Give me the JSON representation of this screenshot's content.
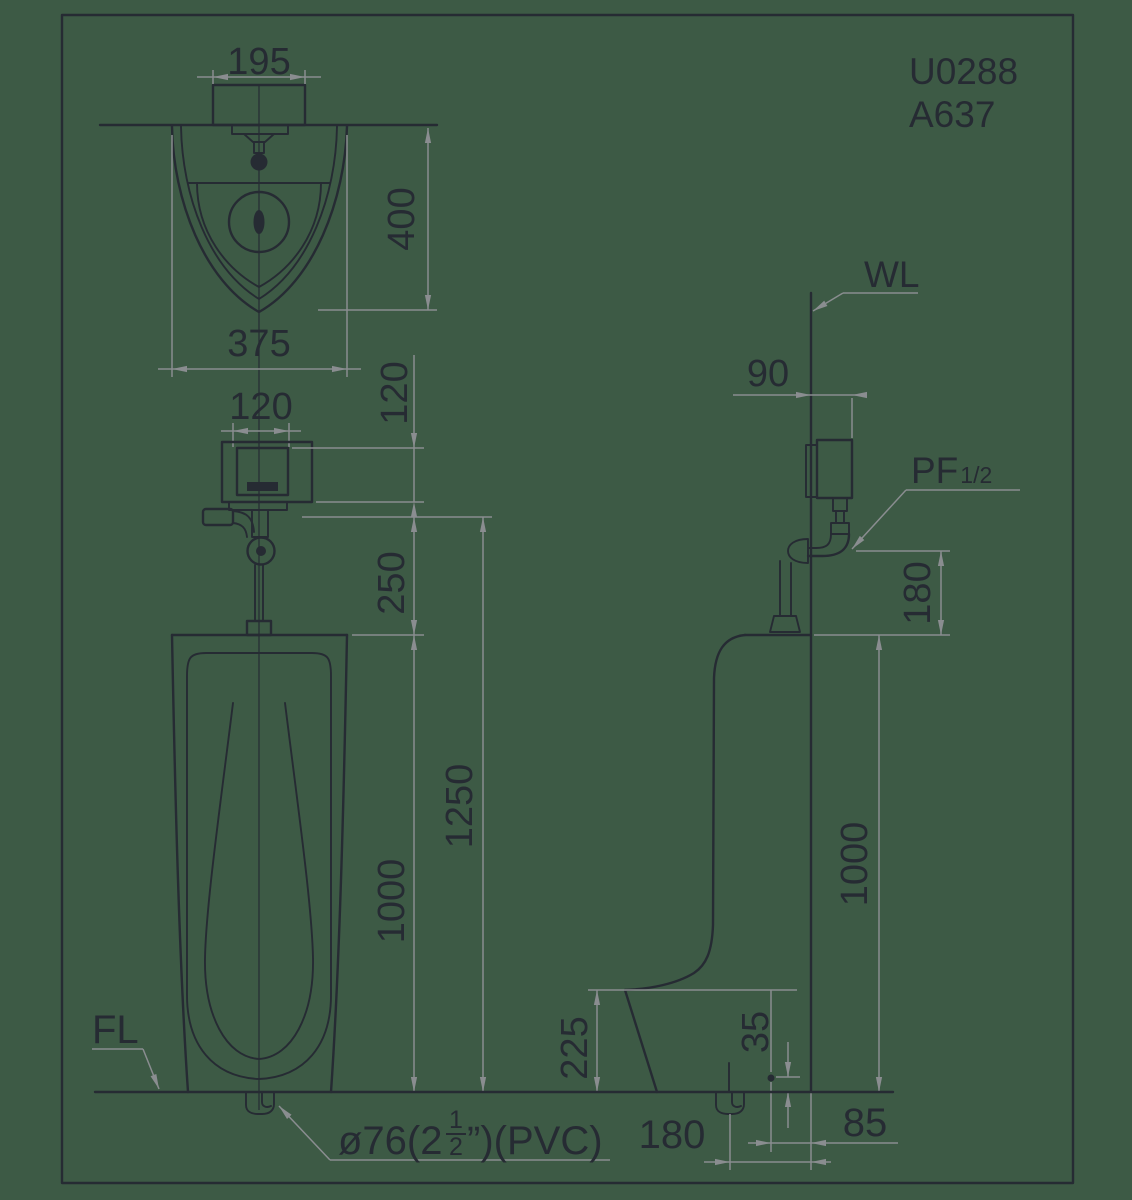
{
  "colors": {
    "background": "#3d5a45",
    "drawing_line": "#262b33",
    "dimension_line": "#8a8d90"
  },
  "title_block": {
    "model_code": "U0288",
    "valve_code": "A637"
  },
  "labels": {
    "wall_line": "WL",
    "floor_line": "FL",
    "inlet_thread_prefix": "PF",
    "inlet_thread_size": "1/2",
    "drain_spec_prefix": "ø76(2",
    "drain_fraction_numerator": "1",
    "drain_fraction_denominator": "2",
    "drain_spec_suffix": "”)(PVC)"
  },
  "front_view": {
    "dims": {
      "mount_width": "195",
      "bowl_depth": "400",
      "bowl_width": "375",
      "valve_width": "120",
      "valve_height": "120",
      "valve_to_rim": "250",
      "rim_to_floor": "1000",
      "supply_height": "1250"
    }
  },
  "side_view": {
    "dims": {
      "valve_from_wall": "90",
      "supply_drop": "180",
      "rim_to_floor": "1000",
      "lip_to_floor": "225",
      "anchor_height": "35",
      "drain_from_wall": "180",
      "anchor_from_wall": "85"
    }
  }
}
